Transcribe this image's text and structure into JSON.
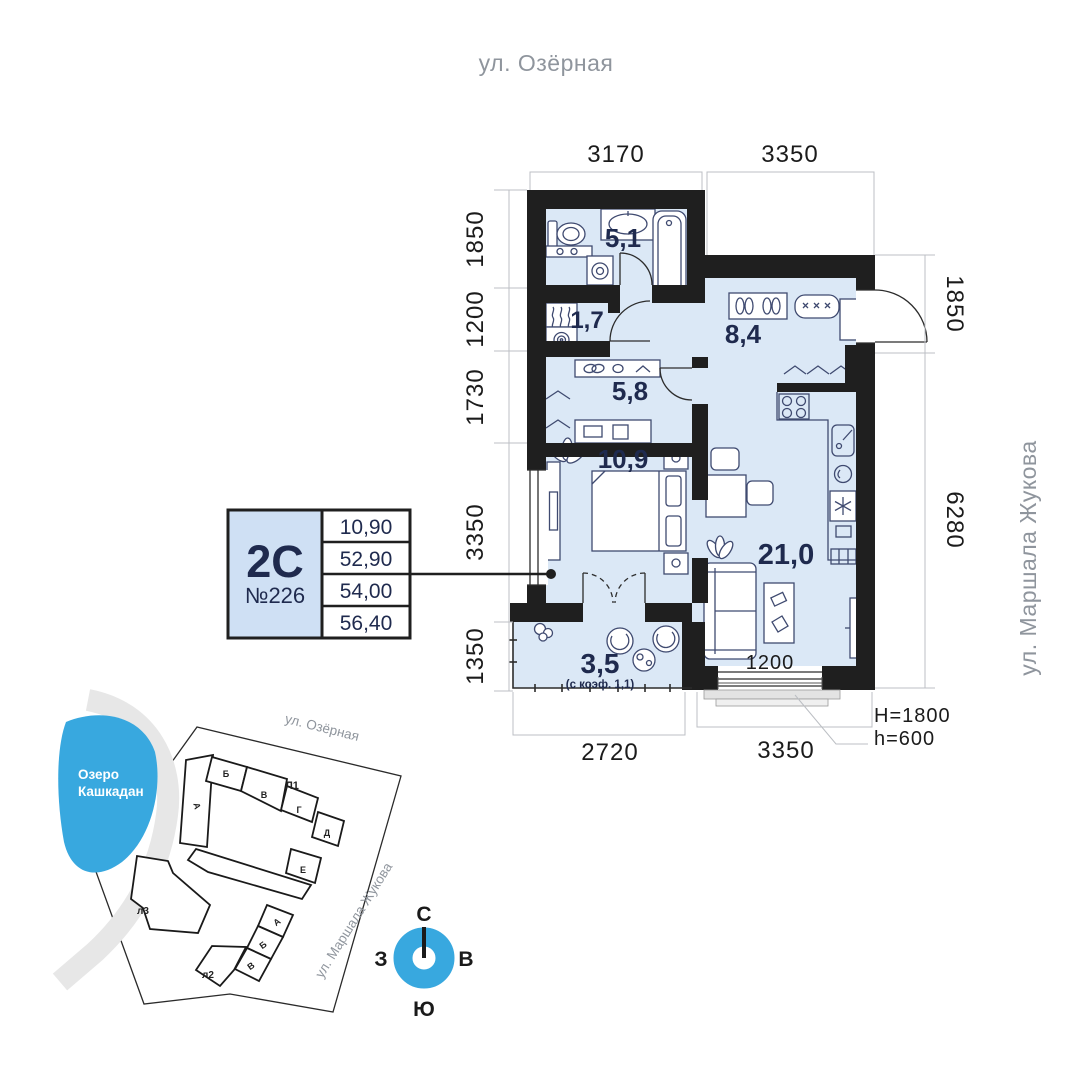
{
  "page": {
    "street_top": "ул. Озёрная",
    "street_right": "ул. Маршала Жукова"
  },
  "rooms": {
    "bathroom": "5,1",
    "storage": "1,7",
    "wardrobe": "5,8",
    "hallway": "8,4",
    "bedroom": "10,9",
    "living": "21,0",
    "balcony": "3,5",
    "balcony_note": "(с коэф. 1,1)"
  },
  "dims": {
    "top_left": "3170",
    "top_right": "3350",
    "left_1": "1850",
    "left_2": "1200",
    "left_3": "1730",
    "left_4": "3350",
    "left_5": "1350",
    "right_1": "1850",
    "right_2": "6280",
    "bottom_left": "2720",
    "bottom_right": "3350",
    "window_width": "1200",
    "window_height": "H=1800",
    "sill_height": "h=600"
  },
  "card": {
    "type": "2С",
    "number": "№226",
    "rows": [
      "10,90",
      "52,90",
      "54,00",
      "56,40"
    ]
  },
  "map": {
    "lake_line1": "Озеро",
    "lake_line2": "Кашкадан",
    "street_top": "ул. Озёрная",
    "street_right": "ул. Маршала Жукова",
    "bld1": "Л1",
    "bld2": "л2",
    "bld3": "л3",
    "s1": "Б",
    "s2": "В",
    "s3": "Г",
    "s4": "Д",
    "s5": "Е",
    "s6": "А",
    "l2s1": "А",
    "l2s2": "Б",
    "l2s3": "В"
  },
  "compass": {
    "n": "С",
    "s": "Ю",
    "w": "З",
    "e": "В"
  },
  "colors": {
    "accent": "#38a8df",
    "floor": "#dbe8f6",
    "wall": "#1f1f1f",
    "navy": "#1f2a4e",
    "highlight": "#bdbdbd"
  }
}
